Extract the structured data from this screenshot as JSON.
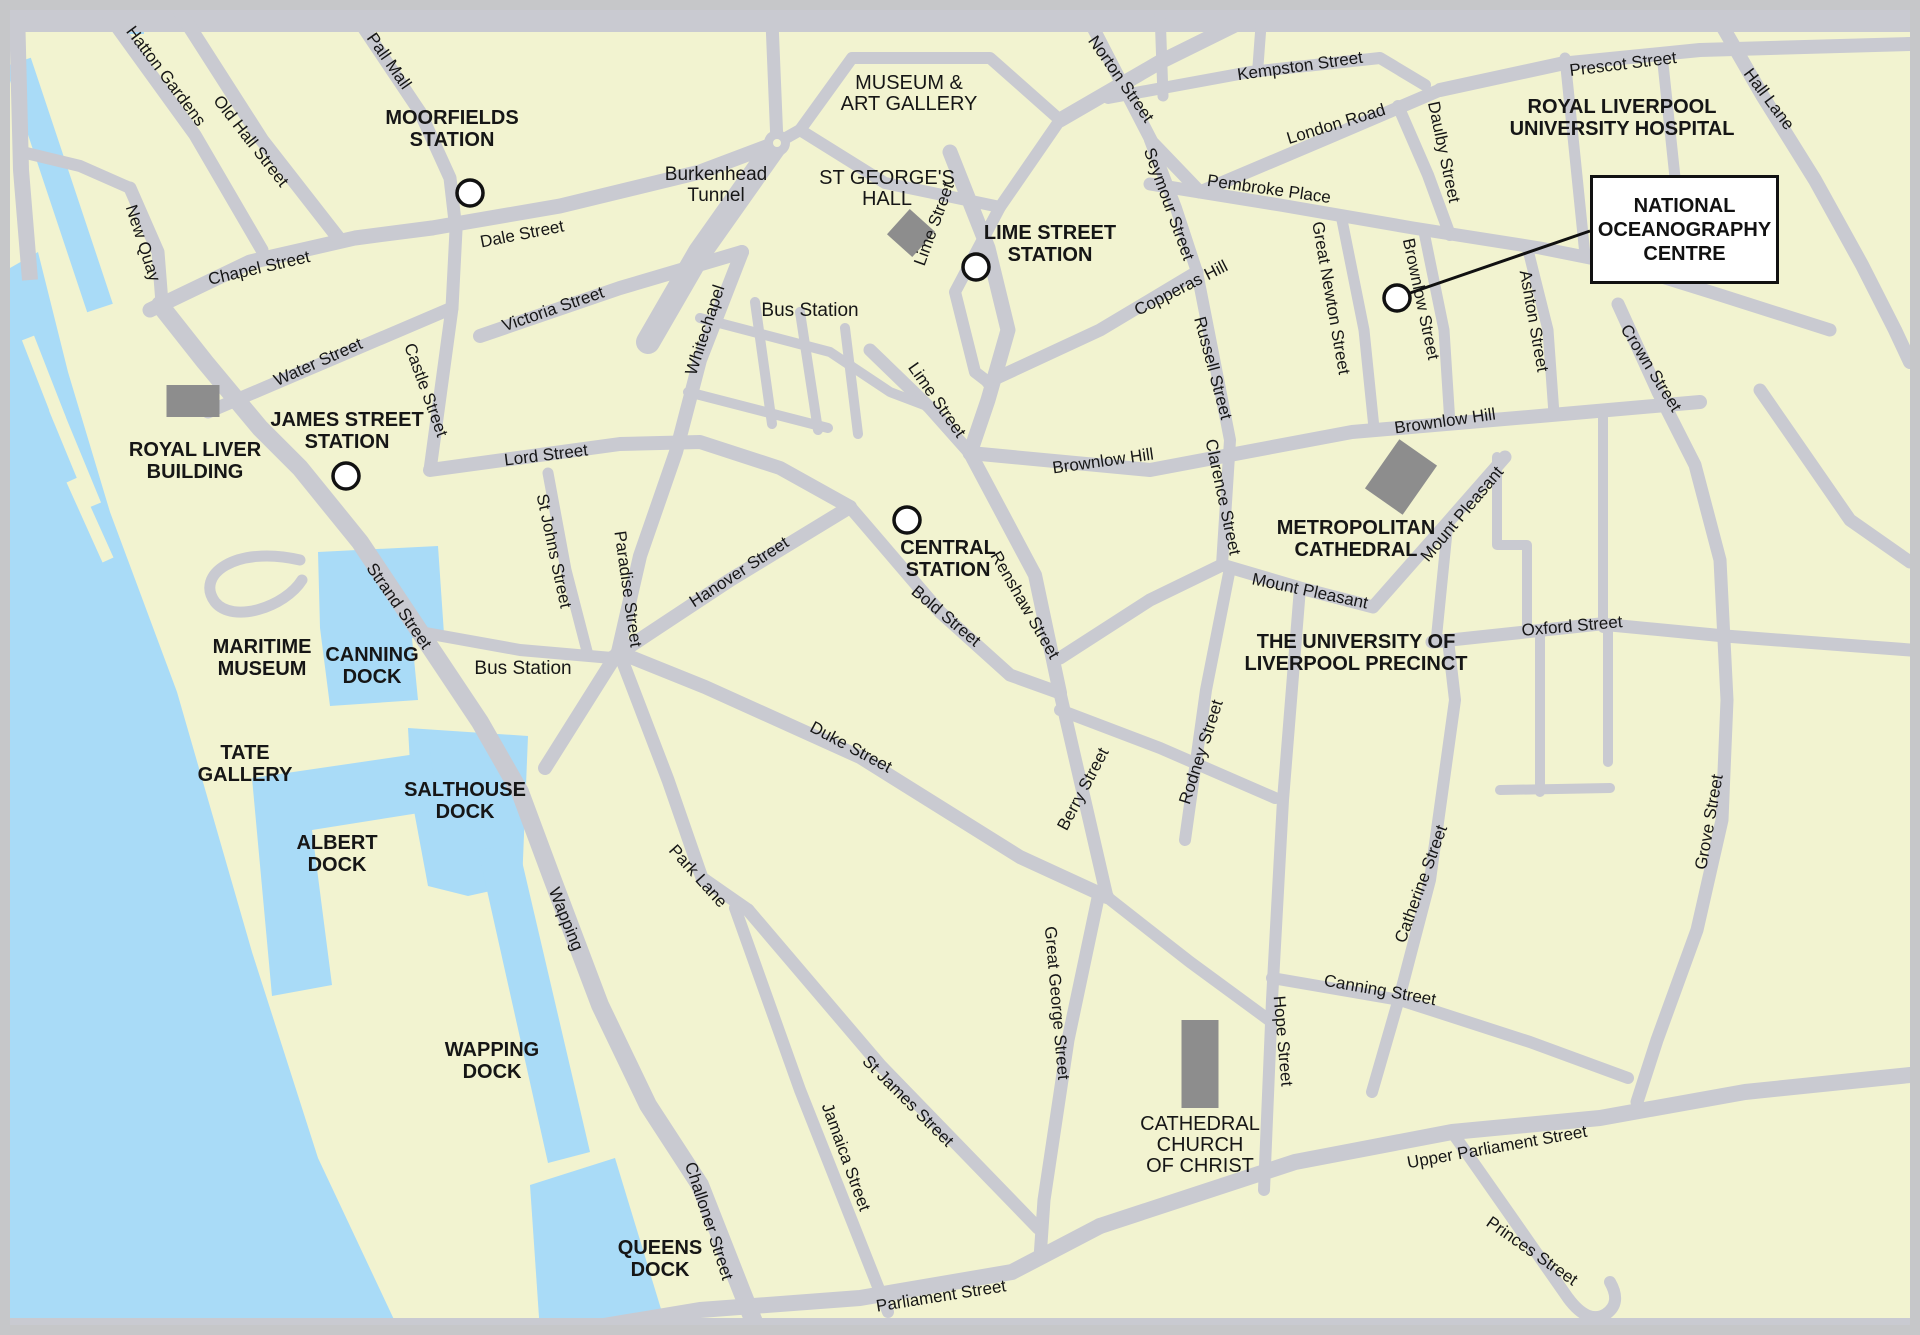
{
  "title": "Liverpool city centre map - National Oceanography Centre",
  "map": {
    "width": 1920,
    "height": 1335
  },
  "colors": {
    "land": "#f2f3d0",
    "water": "#a9dbf7",
    "road": "#c9cad1",
    "frame": "#c6c7c9",
    "building": "#8d8d8d",
    "text": "#161616",
    "marker_fill": "#ffffff",
    "marker_stroke": "#111111"
  },
  "water": {
    "river": "10,268 38,252 68,372 110,512 177,692 252,952 318,1158 398,1328 10,1328",
    "dock_strip": {
      "d": "M18,62 L100,308",
      "w": 27
    },
    "corner_patch": "118,10 144,10 144,34 118,34",
    "docks": [
      {
        "name": "canning-dock-water",
        "points": "318,552 438,546 444,634 412,638 418,700 330,706 320,628"
      },
      {
        "name": "salthouse-dock-water",
        "points": "408,728 528,736 522,884 468,896 428,886 412,800"
      },
      {
        "name": "albert-dock-water",
        "points": "252,778 430,752 438,810 312,830 332,985 272,996"
      },
      {
        "name": "wapping-dock-water",
        "points": "478,850 518,844 590,1152 548,1163"
      },
      {
        "name": "queens-dock-water",
        "points": "530,1185 615,1158 668,1332 540,1332"
      }
    ]
  },
  "piers": [
    {
      "d": "M28,338 L60,420",
      "w": 13
    },
    {
      "d": "M55,408 L95,505",
      "w": 13
    },
    {
      "d": "M72,480 L108,560",
      "w": 12
    }
  ],
  "roads": [
    {
      "name": "top-edge-road",
      "d": "M10,21 H1910",
      "w": 22
    },
    {
      "name": "bottom-edge-road",
      "d": "M10,1327 H1910",
      "w": 18
    },
    {
      "name": "left-edge-road",
      "d": "M17,10 L21,170 L30,280",
      "w": 16
    },
    {
      "name": "the-strand-wapping",
      "d": "M160,305 L205,362 L260,428 L300,468 L360,542 L420,632 L480,722 L520,792 L552,878 L600,1005 L648,1105 L700,1185 L742,1292 L758,1332",
      "w": 18
    },
    {
      "name": "chapel-street",
      "d": "M150,310 L250,262 L355,238 L432,228",
      "w": 15
    },
    {
      "name": "dale-street",
      "d": "M432,228 L560,206 L700,172 L777,143",
      "w": 15
    },
    {
      "name": "old-hall-street",
      "d": "M180,12 L262,140 L340,240",
      "w": 14
    },
    {
      "name": "hatton-gardens",
      "d": "M106,12 L195,135 L262,250",
      "w": 13
    },
    {
      "name": "pall-mall",
      "d": "M353,12 L420,112 L450,178 L456,230 L452,308",
      "w": 13
    },
    {
      "name": "new-quay",
      "d": "M130,188 L158,252 L162,303",
      "w": 13
    },
    {
      "name": "new-quay-link",
      "d": "M22,152 L80,166 L130,188",
      "w": 12
    },
    {
      "name": "water-street",
      "d": "M208,412 L330,360 L452,308",
      "w": 13
    },
    {
      "name": "castle-street",
      "d": "M452,308 L430,470",
      "w": 13
    },
    {
      "name": "lord-street",
      "d": "M430,470 L620,444 L700,442 L780,468 L850,507",
      "w": 14
    },
    {
      "name": "victoria-street",
      "d": "M480,336 L620,288 L742,252",
      "w": 14
    },
    {
      "name": "whitechapel-paradise",
      "d": "M742,252 L700,360 L676,452 L640,556 L618,652 L545,768",
      "w": 14
    },
    {
      "name": "hanover-street",
      "d": "M612,658 L730,580 L850,507",
      "w": 14
    },
    {
      "name": "bold-street",
      "d": "M850,507 L940,612 L1010,675 L1060,693",
      "w": 13
    },
    {
      "name": "renshaw-street",
      "d": "M970,453 L1035,575 L1060,693",
      "w": 14
    },
    {
      "name": "st-johns-street",
      "d": "M548,473 L566,570 L588,655",
      "w": 11
    },
    {
      "name": "bus-station-road",
      "d": "M420,632 L520,650 L612,658",
      "w": 12
    },
    {
      "name": "duke-street",
      "d": "M618,652 L705,687 L860,757 L1020,857 L1107,897",
      "w": 14
    },
    {
      "name": "berry-street",
      "d": "M1060,693 L1107,897",
      "w": 13
    },
    {
      "name": "park-lane",
      "d": "M622,660 L668,780 L702,878 L748,910",
      "w": 13
    },
    {
      "name": "jamaica-street",
      "d": "M735,908 L800,1090 L888,1312",
      "w": 12
    },
    {
      "name": "st-james-street",
      "d": "M748,910 L880,1065 L1038,1228",
      "w": 13
    },
    {
      "name": "great-george-street",
      "d": "M1098,898 L1068,1040 L1044,1200 L1040,1258",
      "w": 13
    },
    {
      "name": "upper-duke-street",
      "d": "M1107,897 L1190,962 L1269,1020",
      "w": 12
    },
    {
      "name": "hardman-street",
      "d": "M1060,710 L1160,748 L1275,798",
      "w": 12
    },
    {
      "name": "rodney-street",
      "d": "M1230,568 L1206,690 L1185,840",
      "w": 12
    },
    {
      "name": "mount-pleasant",
      "d": "M1060,658 L1150,600 L1222,565 L1300,588 L1373,607 L1448,522 L1505,457",
      "w": 13
    },
    {
      "name": "hope-street",
      "d": "M1300,588 L1283,800 L1272,1000 L1264,1190",
      "w": 12
    },
    {
      "name": "canning-street",
      "d": "M1272,978 L1400,1000 L1530,1042 L1628,1078",
      "w": 12
    },
    {
      "name": "catherine-street",
      "d": "M1448,640 L1455,700 L1430,880 L1400,995 L1372,1092",
      "w": 12
    },
    {
      "name": "parliament-street",
      "d": "M580,1330 L700,1310 L860,1298 L1012,1272 L1100,1226",
      "w": 16
    },
    {
      "name": "upper-parliament-street",
      "d": "M1100,1226 L1295,1162 L1452,1132 L1600,1118 L1745,1092 L1910,1075",
      "w": 16
    },
    {
      "name": "princes-street",
      "d": "M1452,1132 L1515,1222 L1568,1298 Q1588,1325 1606,1314 Q1622,1303 1610,1282",
      "w": 12
    },
    {
      "name": "lime-street-road",
      "d": "M950,152 L988,248 L1008,330 L988,400 L970,453",
      "w": 15
    },
    {
      "name": "ranelagh-street",
      "d": "M870,350 L930,408 L970,453",
      "w": 13
    },
    {
      "name": "brownlow-hill-road",
      "d": "M970,453 L1150,470 L1352,432 L1540,416 L1700,402",
      "w": 14
    },
    {
      "name": "copperas-hill-road",
      "d": "M988,382 L1100,330 L1197,272",
      "w": 13
    },
    {
      "name": "russell-clarence-road",
      "d": "M1197,272 L1230,440 L1222,565",
      "w": 12
    },
    {
      "name": "seymour-street-road",
      "d": "M1150,140 L1176,208 L1197,272",
      "w": 12
    },
    {
      "name": "norton-street-road",
      "d": "M1085,12 L1152,142 L1200,192",
      "w": 13
    },
    {
      "name": "london-road",
      "d": "M1200,192 L1330,137 L1440,90",
      "w": 13
    },
    {
      "name": "kempston-street-road",
      "d": "M1108,98 L1250,72 L1380,58 L1425,85",
      "w": 12
    },
    {
      "name": "top-link-1",
      "d": "M1160,12 L1163,96",
      "w": 11
    },
    {
      "name": "top-link-2",
      "d": "M1262,12 L1258,66",
      "w": 11
    },
    {
      "name": "islington-road",
      "d": "M1060,120 L1160,62 L1245,20",
      "w": 15
    },
    {
      "name": "prescot-street-road",
      "d": "M1440,90 L1560,64 L1700,50 L1910,44",
      "w": 14
    },
    {
      "name": "hall-lane-road",
      "d": "M1713,10 L1762,95 L1815,180 L1862,265 L1895,330 L1910,362",
      "w": 14
    },
    {
      "name": "pembroke-place-road",
      "d": "M1150,184 L1280,205 L1413,228 L1540,248 L1620,264 L1720,295 L1830,330",
      "w": 13
    },
    {
      "name": "daulby-street-road",
      "d": "M1398,106 L1428,175 L1450,235",
      "w": 12
    },
    {
      "name": "great-newton-street-road",
      "d": "M1342,220 L1364,330 L1374,428",
      "w": 11
    },
    {
      "name": "brownlow-street-road",
      "d": "M1424,232 L1444,330 L1450,424",
      "w": 11
    },
    {
      "name": "ashton-street-road",
      "d": "M1528,250 L1548,330 L1554,414",
      "w": 11
    },
    {
      "name": "hospital-road-1",
      "d": "M1565,58 L1585,255",
      "w": 11
    },
    {
      "name": "hospital-road-2",
      "d": "M1662,54 L1686,282",
      "w": 11
    },
    {
      "name": "crown-grove-street-road",
      "d": "M1618,304 L1658,392 L1695,465 L1720,560 L1727,700 L1722,820 L1697,930 L1657,1040 L1637,1102",
      "w": 13
    },
    {
      "name": "oxford-street-road",
      "d": "M1432,642 L1600,624 L1725,636 L1910,650",
      "w": 13
    },
    {
      "name": "mount-pleasant-oxford-link",
      "d": "M1448,522 L1436,642",
      "w": 11
    },
    {
      "name": "uni-road-1",
      "d": "M1497,457 L1497,545 L1527,545 L1527,632",
      "w": 10
    },
    {
      "name": "uni-road-2",
      "d": "M1603,412 L1603,628",
      "w": 10
    },
    {
      "name": "uni-road-3",
      "d": "M1540,632 L1540,792",
      "w": 10
    },
    {
      "name": "uni-road-4",
      "d": "M1608,630 L1608,762",
      "w": 10
    },
    {
      "name": "uni-road-5",
      "d": "M1500,790 L1610,788",
      "w": 10
    },
    {
      "name": "east-diagonal-road",
      "d": "M1760,390 L1850,520 L1910,562",
      "w": 13
    },
    {
      "name": "grid-road-1",
      "d": "M700,318 L830,352 L890,392 L932,408",
      "w": 10
    },
    {
      "name": "grid-road-2",
      "d": "M688,392 L828,428",
      "w": 10
    },
    {
      "name": "grid-road-3",
      "d": "M755,302 L772,424",
      "w": 10
    },
    {
      "name": "grid-road-4",
      "d": "M800,312 L818,430",
      "w": 10
    },
    {
      "name": "grid-road-5",
      "d": "M845,328 L858,434",
      "w": 10
    },
    {
      "name": "museum-block-road",
      "d": "M800,130 L852,58 L990,58 L1060,120 L1000,207 L885,183 Z",
      "w": 12
    },
    {
      "name": "st-georges-west-road",
      "d": "M1000,207 L955,292 L975,372 L988,382",
      "w": 12
    },
    {
      "name": "tunnel-approach-road",
      "d": "M777,143 L700,252 L648,342",
      "w": 24
    },
    {
      "name": "roundabout-north-road",
      "d": "M772,22 L777,143",
      "w": 13
    },
    {
      "name": "roundabout-west-link",
      "d": "M777,143 L800,130",
      "w": 12
    },
    {
      "name": "pier-head-loop-road",
      "d": "M300,560 C235,545 195,575 215,602 C233,624 285,607 302,580",
      "w": 11
    }
  ],
  "buildings": [
    {
      "name": "royal-liver-building",
      "cx": 193,
      "cy": 401,
      "w": 53,
      "h": 32,
      "rot": 0
    },
    {
      "name": "st-georges-hall-building",
      "cx": 911,
      "cy": 233,
      "w": 34,
      "h": 34,
      "rot": 42
    },
    {
      "name": "metropolitan-cathedral-building",
      "cx": 1401,
      "cy": 477,
      "w": 46,
      "h": 60,
      "rot": 35
    },
    {
      "name": "cathedral-church-building",
      "cx": 1200,
      "cy": 1064,
      "w": 37,
      "h": 88,
      "rot": 0
    }
  ],
  "roundabout": {
    "x": 777,
    "y": 143,
    "r": 13
  },
  "street_labels": [
    {
      "t": "Pall Mall",
      "x": 389,
      "y": 61,
      "r": 55
    },
    {
      "t": "Hatton Gardens",
      "x": 166,
      "y": 76,
      "r": 53
    },
    {
      "t": "Old Hall Street",
      "x": 251,
      "y": 141,
      "r": 52
    },
    {
      "t": "Chapel Street",
      "x": 259,
      "y": 268,
      "r": -13
    },
    {
      "t": "New Quay",
      "x": 143,
      "y": 243,
      "r": 72
    },
    {
      "t": "Dale Street",
      "x": 522,
      "y": 234,
      "r": -11
    },
    {
      "t": "Victoria Street",
      "x": 553,
      "y": 309,
      "r": -19
    },
    {
      "t": "Whitechapel",
      "x": 705,
      "y": 330,
      "r": -72
    },
    {
      "t": "Water Street",
      "x": 318,
      "y": 362,
      "r": -24
    },
    {
      "t": "Castle Street",
      "x": 426,
      "y": 390,
      "r": 70
    },
    {
      "t": "Lord Street",
      "x": 546,
      "y": 455,
      "r": -7
    },
    {
      "t": "St Johns Street",
      "x": 554,
      "y": 551,
      "r": 78
    },
    {
      "t": "Paradise Street",
      "x": 628,
      "y": 589,
      "r": 82
    },
    {
      "t": "Strand Street",
      "x": 399,
      "y": 606,
      "r": 55
    },
    {
      "t": "Hanover Street",
      "x": 739,
      "y": 572,
      "r": -33
    },
    {
      "t": "Lime Street",
      "x": 934,
      "y": 224,
      "r": -70
    },
    {
      "t": "Lime Street",
      "x": 937,
      "y": 400,
      "r": 55
    },
    {
      "t": "Bold Street",
      "x": 946,
      "y": 616,
      "r": 40
    },
    {
      "t": "Renshaw Street",
      "x": 1025,
      "y": 605,
      "r": 60
    },
    {
      "t": "Norton Street",
      "x": 1121,
      "y": 79,
      "r": 55
    },
    {
      "t": "Kempston Street",
      "x": 1300,
      "y": 66,
      "r": -8
    },
    {
      "t": "London Road",
      "x": 1336,
      "y": 124,
      "r": -17
    },
    {
      "t": "Prescot Street",
      "x": 1623,
      "y": 64,
      "r": -7
    },
    {
      "t": "Hall Lane",
      "x": 1769,
      "y": 99,
      "r": 53
    },
    {
      "t": "Pembroke Place",
      "x": 1269,
      "y": 189,
      "r": 8
    },
    {
      "t": "Seymour Street",
      "x": 1169,
      "y": 204,
      "r": 70
    },
    {
      "t": "Copperas Hill",
      "x": 1181,
      "y": 288,
      "r": -27
    },
    {
      "t": "Russell Street",
      "x": 1213,
      "y": 368,
      "r": 75
    },
    {
      "t": "Clarence Street",
      "x": 1223,
      "y": 497,
      "r": 78
    },
    {
      "t": "Daulby Street",
      "x": 1444,
      "y": 152,
      "r": 78
    },
    {
      "t": "Great Newton Street",
      "x": 1331,
      "y": 298,
      "r": 80
    },
    {
      "t": "Brownlow Street",
      "x": 1421,
      "y": 299,
      "r": 78
    },
    {
      "t": "Ashton Street",
      "x": 1534,
      "y": 321,
      "r": 80
    },
    {
      "t": "Crown Street",
      "x": 1651,
      "y": 368,
      "r": 58
    },
    {
      "t": "Brownlow Hill",
      "x": 1103,
      "y": 461,
      "r": -8
    },
    {
      "t": "Brownlow Hill",
      "x": 1445,
      "y": 421,
      "r": -8
    },
    {
      "t": "Mount Pleasant",
      "x": 1462,
      "y": 514,
      "r": -50
    },
    {
      "t": "Mount Pleasant",
      "x": 1310,
      "y": 591,
      "r": 12
    },
    {
      "t": "Oxford Street",
      "x": 1572,
      "y": 626,
      "r": -5
    },
    {
      "t": "Grove Street",
      "x": 1709,
      "y": 822,
      "r": -80
    },
    {
      "t": "Duke Street",
      "x": 851,
      "y": 747,
      "r": 28
    },
    {
      "t": "Berry Street",
      "x": 1083,
      "y": 789,
      "r": -62
    },
    {
      "t": "Rodney Street",
      "x": 1201,
      "y": 752,
      "r": -72
    },
    {
      "t": "Catherine Street",
      "x": 1421,
      "y": 884,
      "r": -70
    },
    {
      "t": "Hope Street",
      "x": 1283,
      "y": 1041,
      "r": 85
    },
    {
      "t": "Canning Street",
      "x": 1380,
      "y": 990,
      "r": 10
    },
    {
      "t": "Park Lane",
      "x": 698,
      "y": 876,
      "r": 48
    },
    {
      "t": "Wapping",
      "x": 566,
      "y": 919,
      "r": 68
    },
    {
      "t": "Challoner Street",
      "x": 709,
      "y": 1221,
      "r": 72
    },
    {
      "t": "Jamaica Street",
      "x": 846,
      "y": 1157,
      "r": 70
    },
    {
      "t": "St James Street",
      "x": 908,
      "y": 1101,
      "r": 45
    },
    {
      "t": "Great George Street",
      "x": 1057,
      "y": 1003,
      "r": 85
    },
    {
      "t": "Upper Parliament Street",
      "x": 1497,
      "y": 1147,
      "r": -10
    },
    {
      "t": "Princes Street",
      "x": 1532,
      "y": 1251,
      "r": 35
    },
    {
      "t": "Parliament Street",
      "x": 941,
      "y": 1296,
      "r": -9
    }
  ],
  "poi_labels": [
    {
      "name": "moorfields-station-label",
      "lines": [
        "MOORFIELDS",
        "STATION"
      ],
      "x": 452,
      "y": 118,
      "cls": "poi"
    },
    {
      "name": "museum-art-gallery-label",
      "lines": [
        "MUSEUM &",
        "ART GALLERY"
      ],
      "x": 909,
      "y": 83,
      "cls": "poi-reg"
    },
    {
      "name": "st-georges-hall-label",
      "lines": [
        "ST GEORGE'S",
        "HALL"
      ],
      "x": 887,
      "y": 178,
      "cls": "poi-reg"
    },
    {
      "name": "lime-street-station-label",
      "lines": [
        "LIME STREET",
        "STATION"
      ],
      "x": 1050,
      "y": 233,
      "cls": "poi"
    },
    {
      "name": "burkenhead-tunnel-label",
      "lines": [
        "Burkenhead",
        "Tunnel"
      ],
      "x": 716,
      "y": 174,
      "cls": "place"
    },
    {
      "name": "bus-station-upper-label",
      "lines": [
        "Bus Station"
      ],
      "x": 810,
      "y": 310,
      "cls": "place"
    },
    {
      "name": "royal-liver-building-label",
      "lines": [
        "ROYAL LIVER",
        "BUILDING"
      ],
      "x": 195,
      "y": 450,
      "cls": "poi"
    },
    {
      "name": "james-street-station-label",
      "lines": [
        "JAMES STREET",
        "STATION"
      ],
      "x": 347,
      "y": 420,
      "cls": "poi"
    },
    {
      "name": "central-station-label",
      "lines": [
        "CENTRAL",
        "STATION"
      ],
      "x": 948,
      "y": 548,
      "cls": "poi"
    },
    {
      "name": "royal-liverpool-hospital-label",
      "lines": [
        "ROYAL LIVERPOOL",
        "UNIVERSITY  HOSPITAL"
      ],
      "x": 1622,
      "y": 107,
      "cls": "poi"
    },
    {
      "name": "metropolitan-cathedral-label",
      "lines": [
        "METROPOLITAN",
        "CATHEDRAL"
      ],
      "x": 1356,
      "y": 528,
      "cls": "poi"
    },
    {
      "name": "university-precinct-label",
      "lines": [
        "THE UNIVERSITY OF",
        "LIVERPOOL PRECINCT"
      ],
      "x": 1356,
      "y": 642,
      "cls": "poi"
    },
    {
      "name": "maritime-museum-label",
      "lines": [
        "MARITIME",
        "MUSEUM"
      ],
      "x": 262,
      "y": 647,
      "cls": "poi"
    },
    {
      "name": "canning-dock-label",
      "lines": [
        "CANNING",
        "DOCK"
      ],
      "x": 372,
      "y": 655,
      "cls": "poi"
    },
    {
      "name": "tate-gallery-label",
      "lines": [
        "TATE",
        "GALLERY"
      ],
      "x": 245,
      "y": 753,
      "cls": "poi"
    },
    {
      "name": "albert-dock-label",
      "lines": [
        "ALBERT",
        "DOCK"
      ],
      "x": 337,
      "y": 843,
      "cls": "poi"
    },
    {
      "name": "salthouse-dock-label",
      "lines": [
        "SALTHOUSE",
        "DOCK"
      ],
      "x": 465,
      "y": 790,
      "cls": "poi"
    },
    {
      "name": "bus-station-lower-label",
      "lines": [
        "Bus Station"
      ],
      "x": 523,
      "y": 668,
      "cls": "place"
    },
    {
      "name": "wapping-dock-label",
      "lines": [
        "WAPPING",
        "DOCK"
      ],
      "x": 492,
      "y": 1050,
      "cls": "poi"
    },
    {
      "name": "queens-dock-label",
      "lines": [
        "QUEENS",
        "DOCK"
      ],
      "x": 660,
      "y": 1248,
      "cls": "poi"
    },
    {
      "name": "cathedral-church-label",
      "lines": [
        "CATHEDRAL",
        "CHURCH",
        "OF CHRIST"
      ],
      "x": 1200,
      "y": 1124,
      "cls": "poi-reg"
    }
  ],
  "markers": [
    {
      "name": "moorfields-station-marker",
      "x": 470,
      "y": 193
    },
    {
      "name": "lime-street-station-marker",
      "x": 976,
      "y": 267
    },
    {
      "name": "james-street-station-marker",
      "x": 346,
      "y": 476
    },
    {
      "name": "central-station-marker",
      "x": 907,
      "y": 520
    },
    {
      "name": "noc-marker",
      "x": 1397,
      "y": 298
    }
  ],
  "callout": {
    "lines": [
      "NATIONAL",
      "OCEANOGRAPHY",
      "CENTRE"
    ],
    "box": {
      "x": 1590,
      "y": 175,
      "w": 183,
      "h": 103
    },
    "leader": {
      "x1": 1410,
      "y1": 293,
      "x2": 1590,
      "y2": 231
    }
  }
}
